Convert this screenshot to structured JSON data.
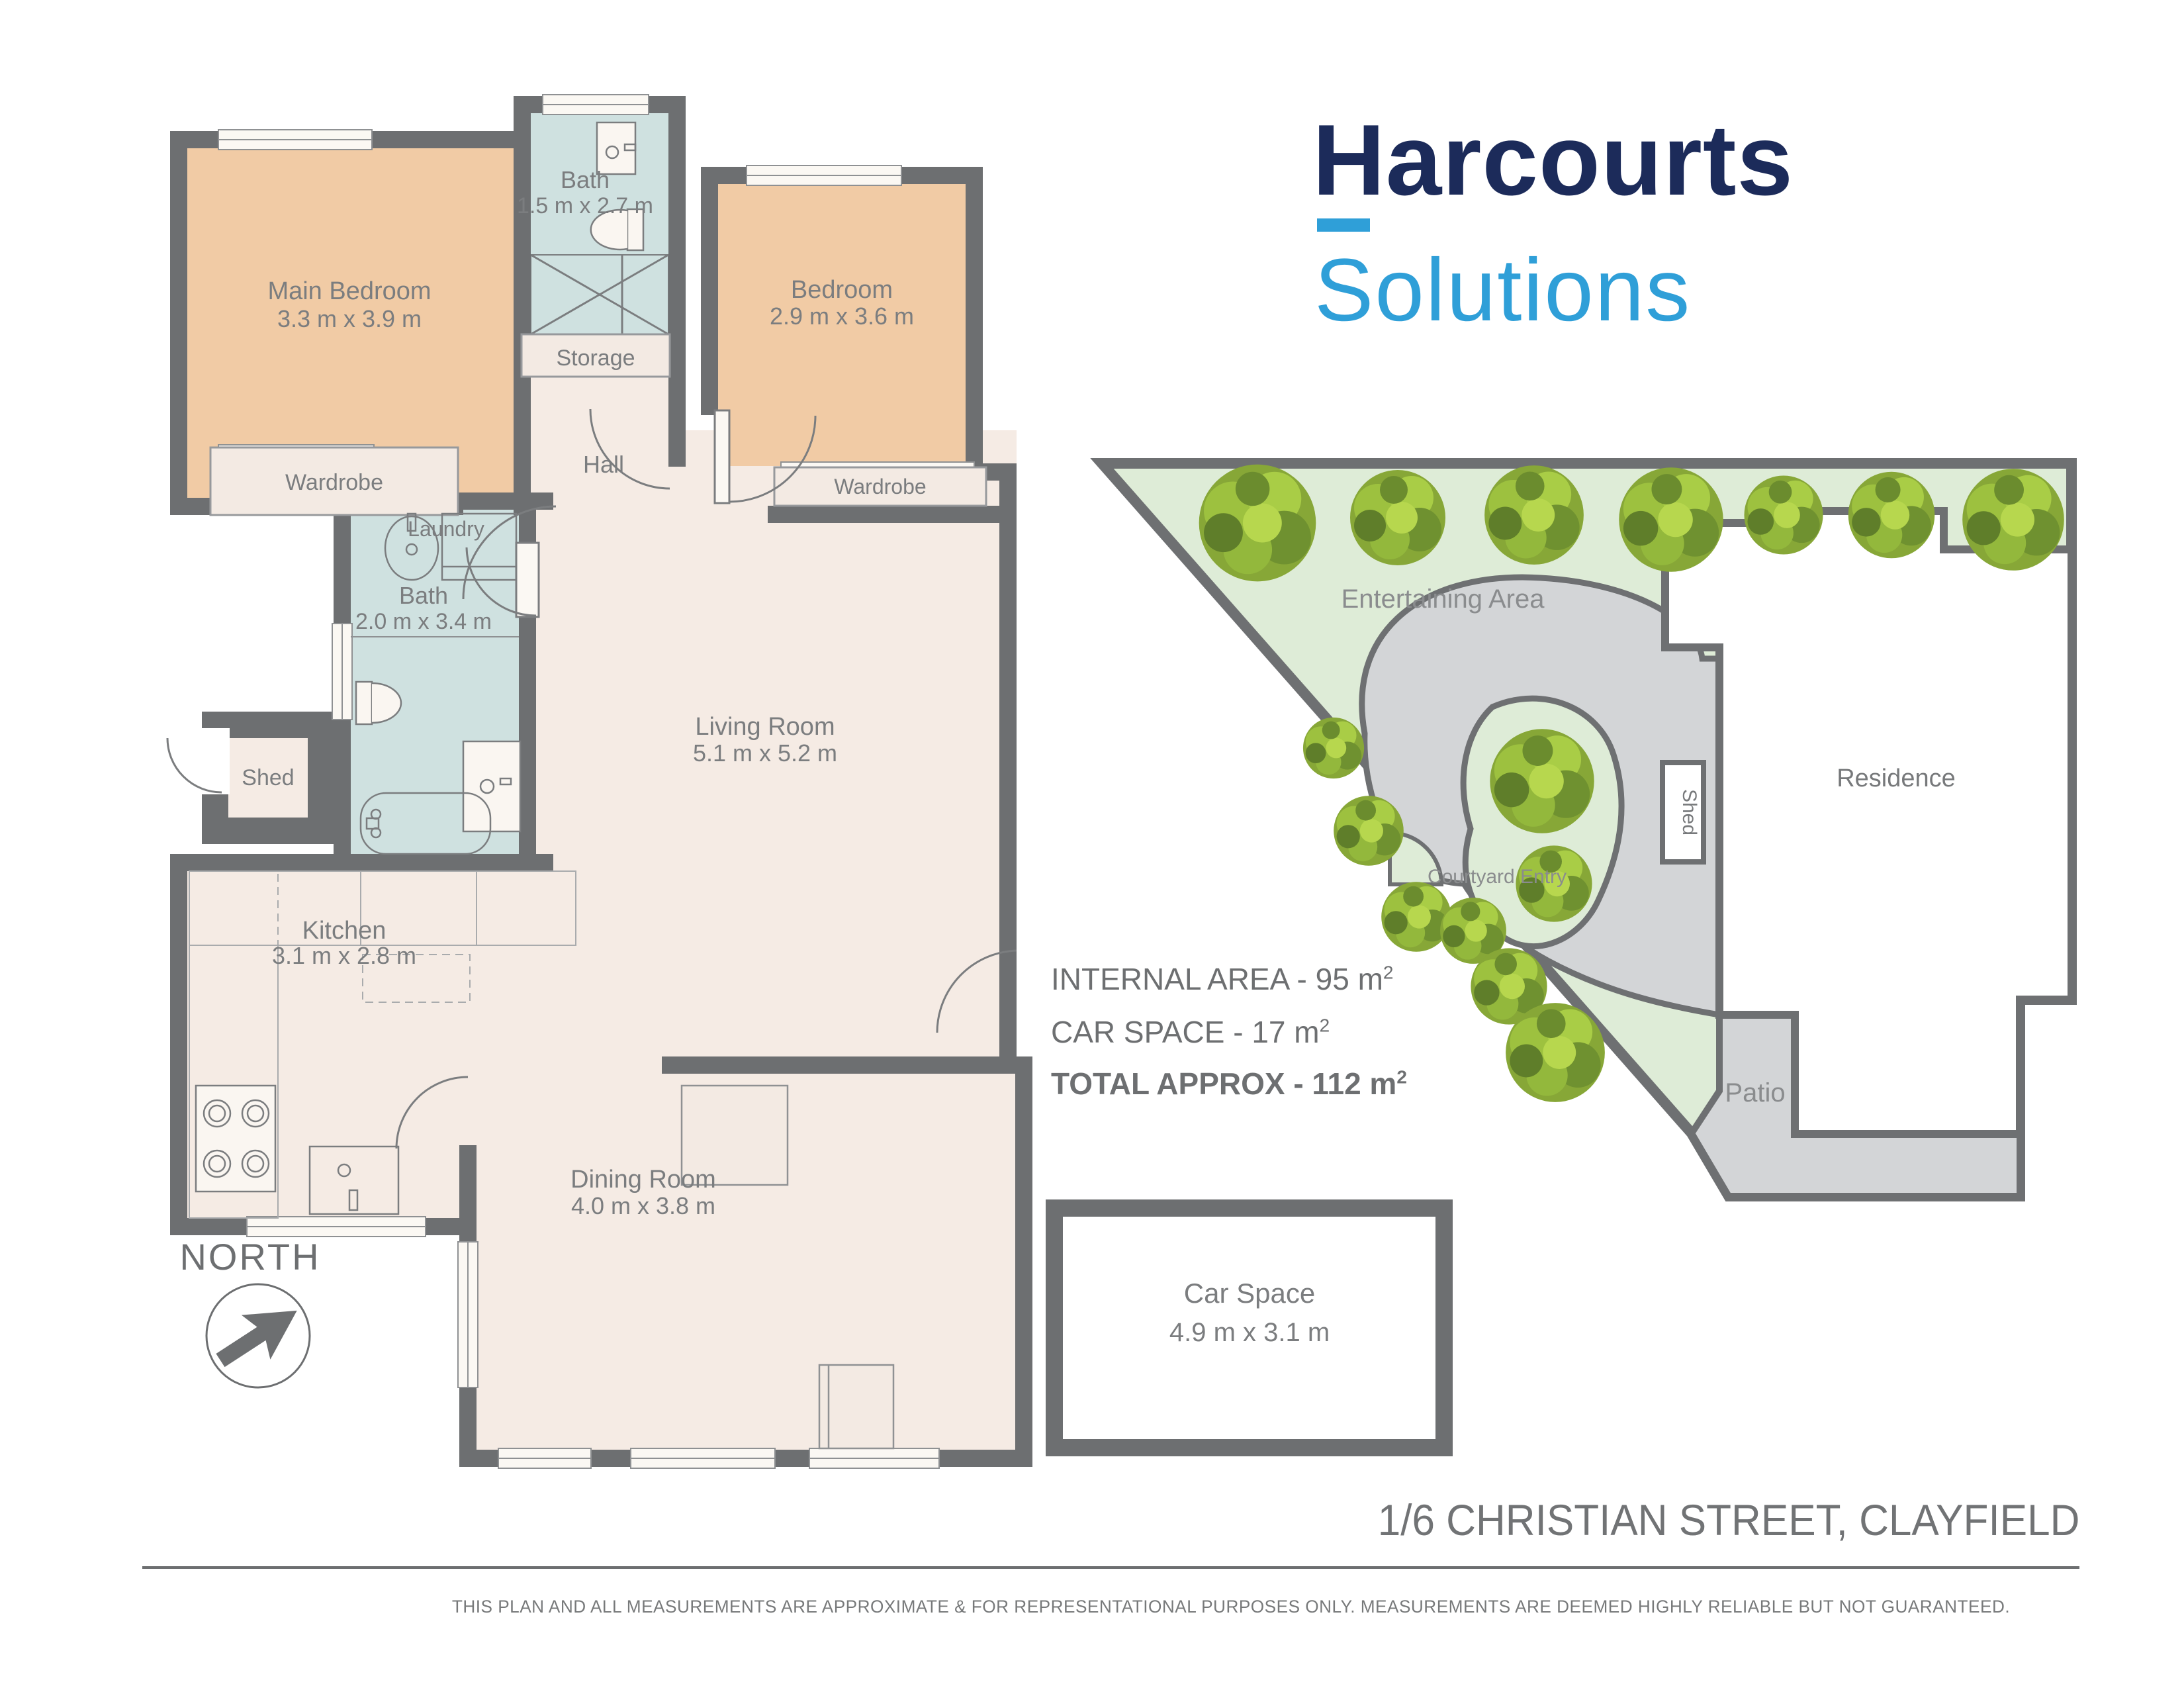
{
  "logo": {
    "brand": "Harcourts",
    "product": "Solutions",
    "brand_color": "#1c2b5a",
    "product_color": "#2f9fd8"
  },
  "rooms": {
    "main_bedroom": {
      "label": "Main Bedroom",
      "dims": "3.3 m x 3.9 m"
    },
    "bath_top": {
      "label": "Bath",
      "dims": "1.5 m x 2.7 m"
    },
    "bedroom": {
      "label": "Bedroom",
      "dims": "2.9 m x 3.6 m"
    },
    "storage": {
      "label": "Storage"
    },
    "hall": {
      "label": "Hall"
    },
    "wardrobe_left": {
      "label": "Wardrobe"
    },
    "wardrobe_right": {
      "label": "Wardrobe"
    },
    "laundry": {
      "label": "Laundry"
    },
    "bath_main": {
      "label": "Bath",
      "dims": "2.0 m x 3.4 m"
    },
    "shed": {
      "label": "Shed"
    },
    "living": {
      "label": "Living Room",
      "dims": "5.1 m x 5.2 m"
    },
    "kitchen": {
      "label": "Kitchen",
      "dims": "3.1 m x 2.8 m"
    },
    "dining": {
      "label": "Dining Room",
      "dims": "4.0 m x 3.8 m"
    }
  },
  "site": {
    "entertaining_area": "Entertaining Area",
    "courtyard_entry": "Courtyard Entry",
    "residence": "Residence",
    "shed": "Shed",
    "patio": "Patio"
  },
  "areas": {
    "internal_label": "INTERNAL AREA - 95 m",
    "internal_sup": "2",
    "car_label": "CAR SPACE - 17 m",
    "car_sup": "2",
    "total_label": "TOTAL APPROX - 112 m",
    "total_sup": "2"
  },
  "car_space_box": {
    "label": "Car Space",
    "dims": "4.9 m x 3.1 m"
  },
  "north": {
    "label": "NORTH"
  },
  "footer": {
    "address": "1/6 CHRISTIAN STREET, CLAYFIELD",
    "disclaimer": "THIS PLAN AND ALL MEASUREMENTS ARE APPROXIMATE & FOR REPRESENTATIONAL PURPOSES ONLY. MEASUREMENTS ARE DEEMED HIGHLY RELIABLE BUT NOT GUARANTEED."
  },
  "colors": {
    "wall": "#6d6f71",
    "bedroom_fill": "#f1cba5",
    "wet_fill": "#cfe1e0",
    "floor_fill": "#f5ebe4",
    "site_green": "#deecd7",
    "site_path": "#d3d5d7",
    "label_gray": "#7b7d7f"
  }
}
